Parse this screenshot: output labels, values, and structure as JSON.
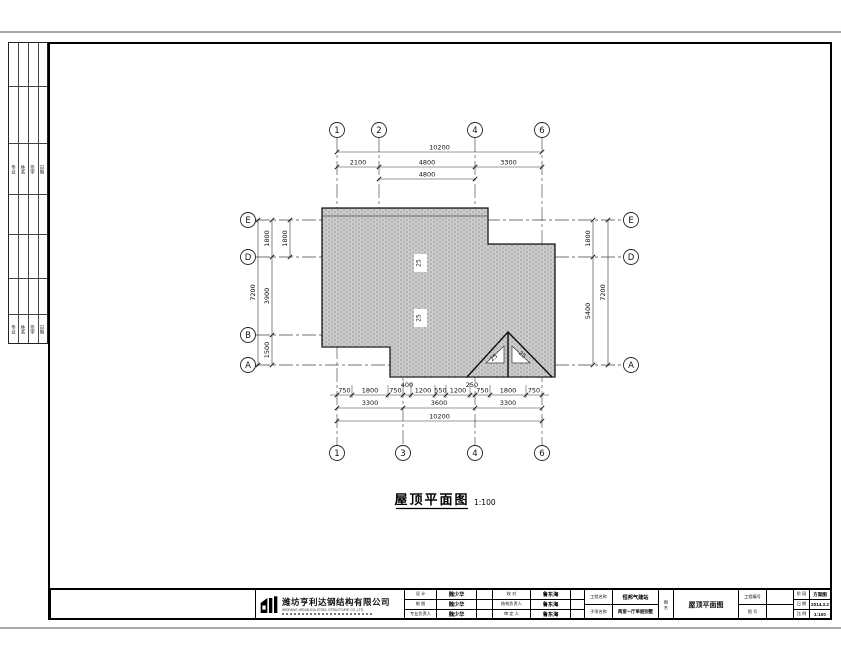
{
  "sheet": {
    "drawing_title": "屋顶平面图",
    "drawing_scale": "1:100"
  },
  "grid": {
    "top": [
      "1",
      "2",
      "4",
      "6"
    ],
    "bottom": [
      "1",
      "3",
      "4",
      "6"
    ],
    "left": [
      "E",
      "D",
      "B",
      "A"
    ],
    "right": [
      "E",
      "D",
      "A"
    ]
  },
  "dims": {
    "top_overall": "10200",
    "top_row2": [
      "2100",
      "4800",
      "3300"
    ],
    "top_row3": "4800",
    "bottom_row1": [
      "750",
      "1800",
      "750",
      "1200",
      "550",
      "1200",
      "750",
      "1800",
      "750"
    ],
    "bottom_row1_raised": [
      "400",
      "250"
    ],
    "bottom_row2": [
      "3300",
      "3600",
      "3300"
    ],
    "bottom_overall": "10200",
    "left_overall": "7200",
    "left_segments": [
      "1800",
      "3900",
      "1500"
    ],
    "left_inner": "1800",
    "right_segments": [
      "1800",
      "5400"
    ],
    "right_overall": "7200",
    "slope": "25"
  },
  "signature_strip": {
    "columns": [
      "专业",
      "姓名",
      "签字",
      "日期"
    ]
  },
  "titleblock": {
    "company": "潍坊亨利达钢结构有限公司",
    "company_en": "WEIFANG HENGLIDA STEEL STRUCTURE CO.,LTD.",
    "col1_rows": [
      {
        "label": "设 计",
        "value": "魏少华"
      },
      {
        "label": "制 图",
        "value": "魏少华"
      },
      {
        "label": "专业负责人",
        "value": "魏少华"
      }
    ],
    "col2_rows": [
      {
        "label": "校 对",
        "value": "鲁东海"
      },
      {
        "label": "结构负责人",
        "value": "鲁东海"
      },
      {
        "label": "审 定 人",
        "value": "鲁东海"
      }
    ],
    "project_label": "工程名称",
    "project_value": "恒邦气建站",
    "subproject_label": "子项名称",
    "subproject_value": "两室一厅单层别墅",
    "sheetname_label": "图 名",
    "sheetname_value": "屋顶平面图",
    "projectno_label": "工程编号",
    "projectno_value": "",
    "sheetno_label": "图 号",
    "sheetno_value": "",
    "stage_label": "阶 段",
    "stage_value": "方案图",
    "date_label": "日 期",
    "date_value": "2014.3.2",
    "scale_label": "比 例",
    "scale_value": "1:100"
  }
}
